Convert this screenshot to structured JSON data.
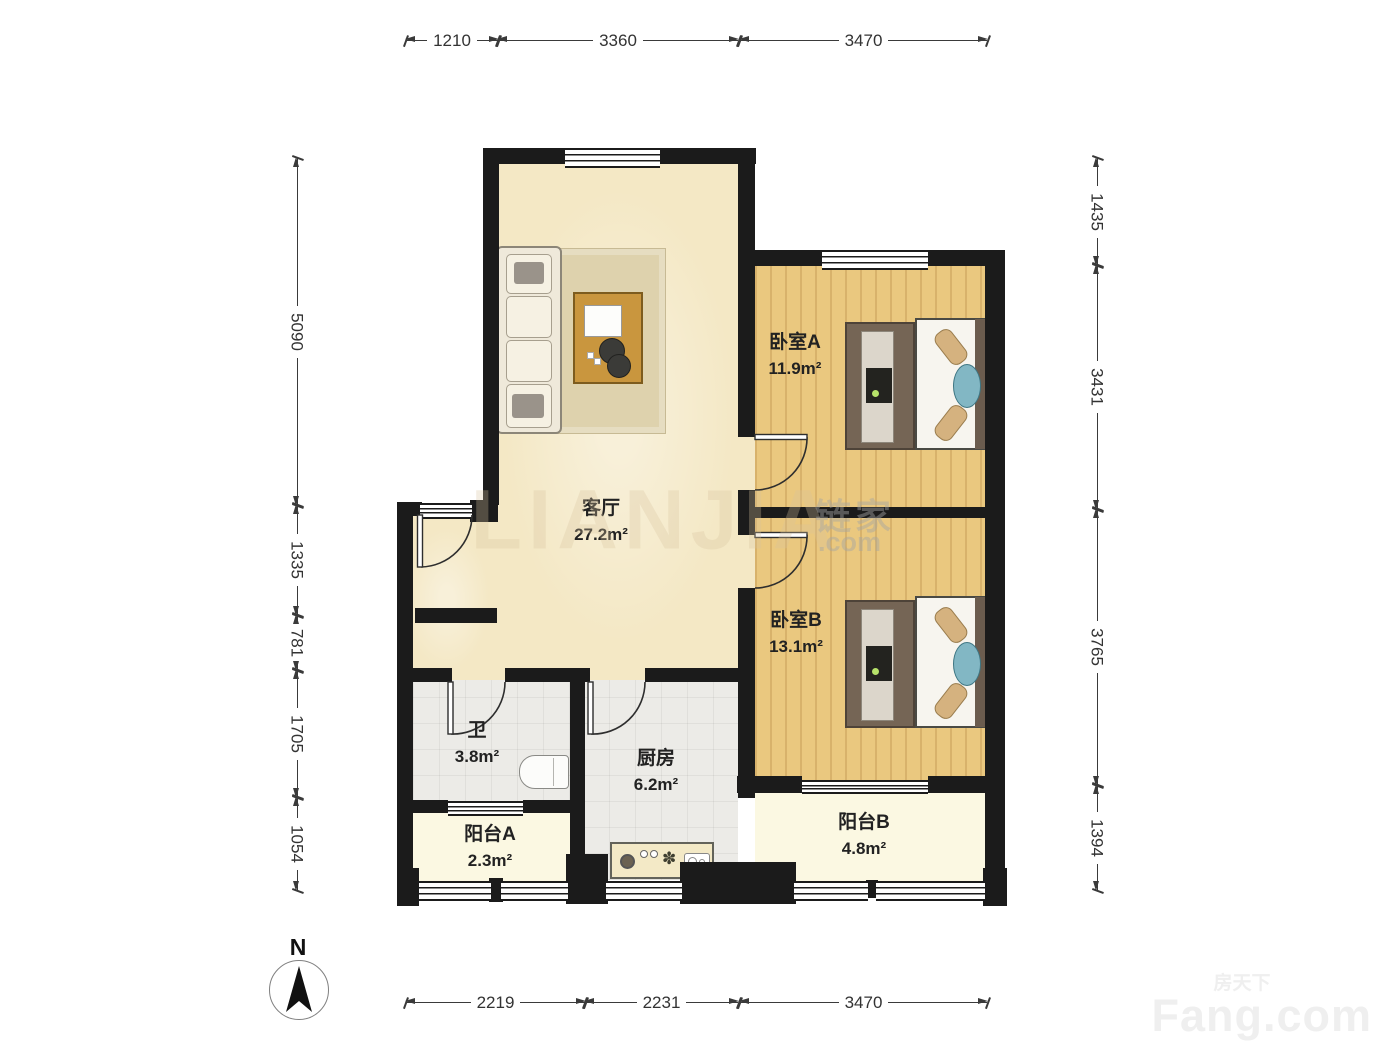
{
  "rooms": [
    {
      "id": "living",
      "name": "客厅",
      "area": "27.2m²"
    },
    {
      "id": "bedroomA",
      "name": "卧室A",
      "area": "11.9m²"
    },
    {
      "id": "bedroomB",
      "name": "卧室B",
      "area": "13.1m²"
    },
    {
      "id": "bathroom",
      "name": "卫",
      "area": "3.8m²"
    },
    {
      "id": "kitchen",
      "name": "厨房",
      "area": "6.2m²"
    },
    {
      "id": "balconyA",
      "name": "阳台A",
      "area": "2.3m²"
    },
    {
      "id": "balconyB",
      "name": "阳台B",
      "area": "4.8m²"
    }
  ],
  "dimensions": {
    "top": [
      "1210",
      "3360",
      "3470"
    ],
    "bottom": [
      "2219",
      "2231",
      "3470"
    ],
    "left": [
      "5090",
      "1335",
      "781",
      "1705",
      "1054"
    ],
    "right": [
      "1435",
      "3431",
      "3765",
      "1394"
    ]
  },
  "compass": {
    "label": "N"
  },
  "watermarks": {
    "center_main": "LIANJIA",
    "center_cn": "链家",
    "center_com": ".com",
    "corner_cn": "房天下",
    "corner_en": "Fang.com"
  },
  "colors": {
    "wall": "#1b1b1b",
    "living_floor": "#f4e8c5",
    "wood_floor": "#eac87f",
    "tile_floor": "#ecebe7",
    "balcony_floor": "#fbf8e2",
    "accent_teal": "#82b7c4",
    "dim_text": "#333333"
  }
}
